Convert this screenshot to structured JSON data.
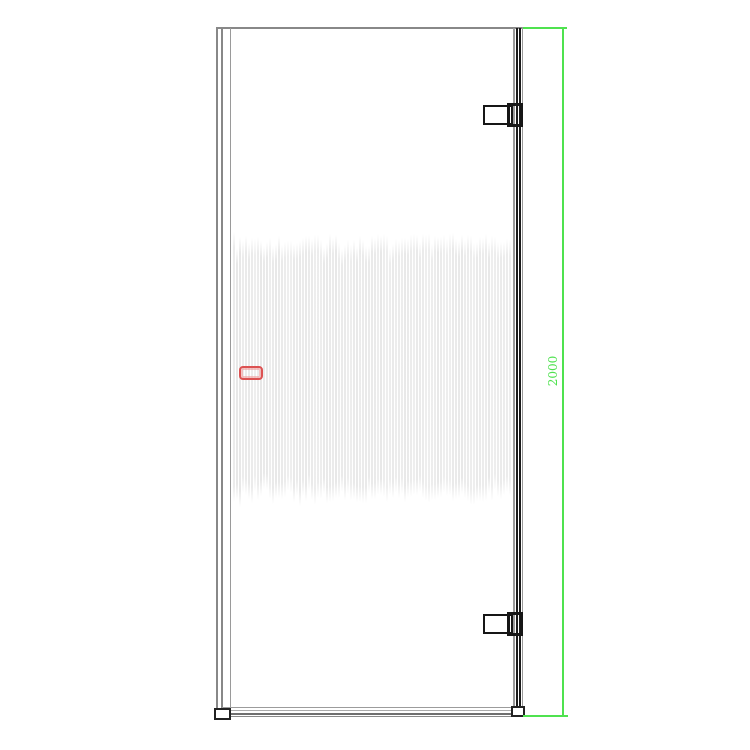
{
  "drawing": {
    "height_dimension": {
      "label": "2000",
      "color": "#4fe24f"
    },
    "marker": {
      "color": "#dc5252"
    },
    "palette": {
      "frame_gray": "#888888",
      "edge_black": "#1b1b1b",
      "stripe_gray": "#e8e8e8",
      "background": "#ffffff"
    },
    "fluted_pattern": {
      "stripe_count": 93
    }
  }
}
